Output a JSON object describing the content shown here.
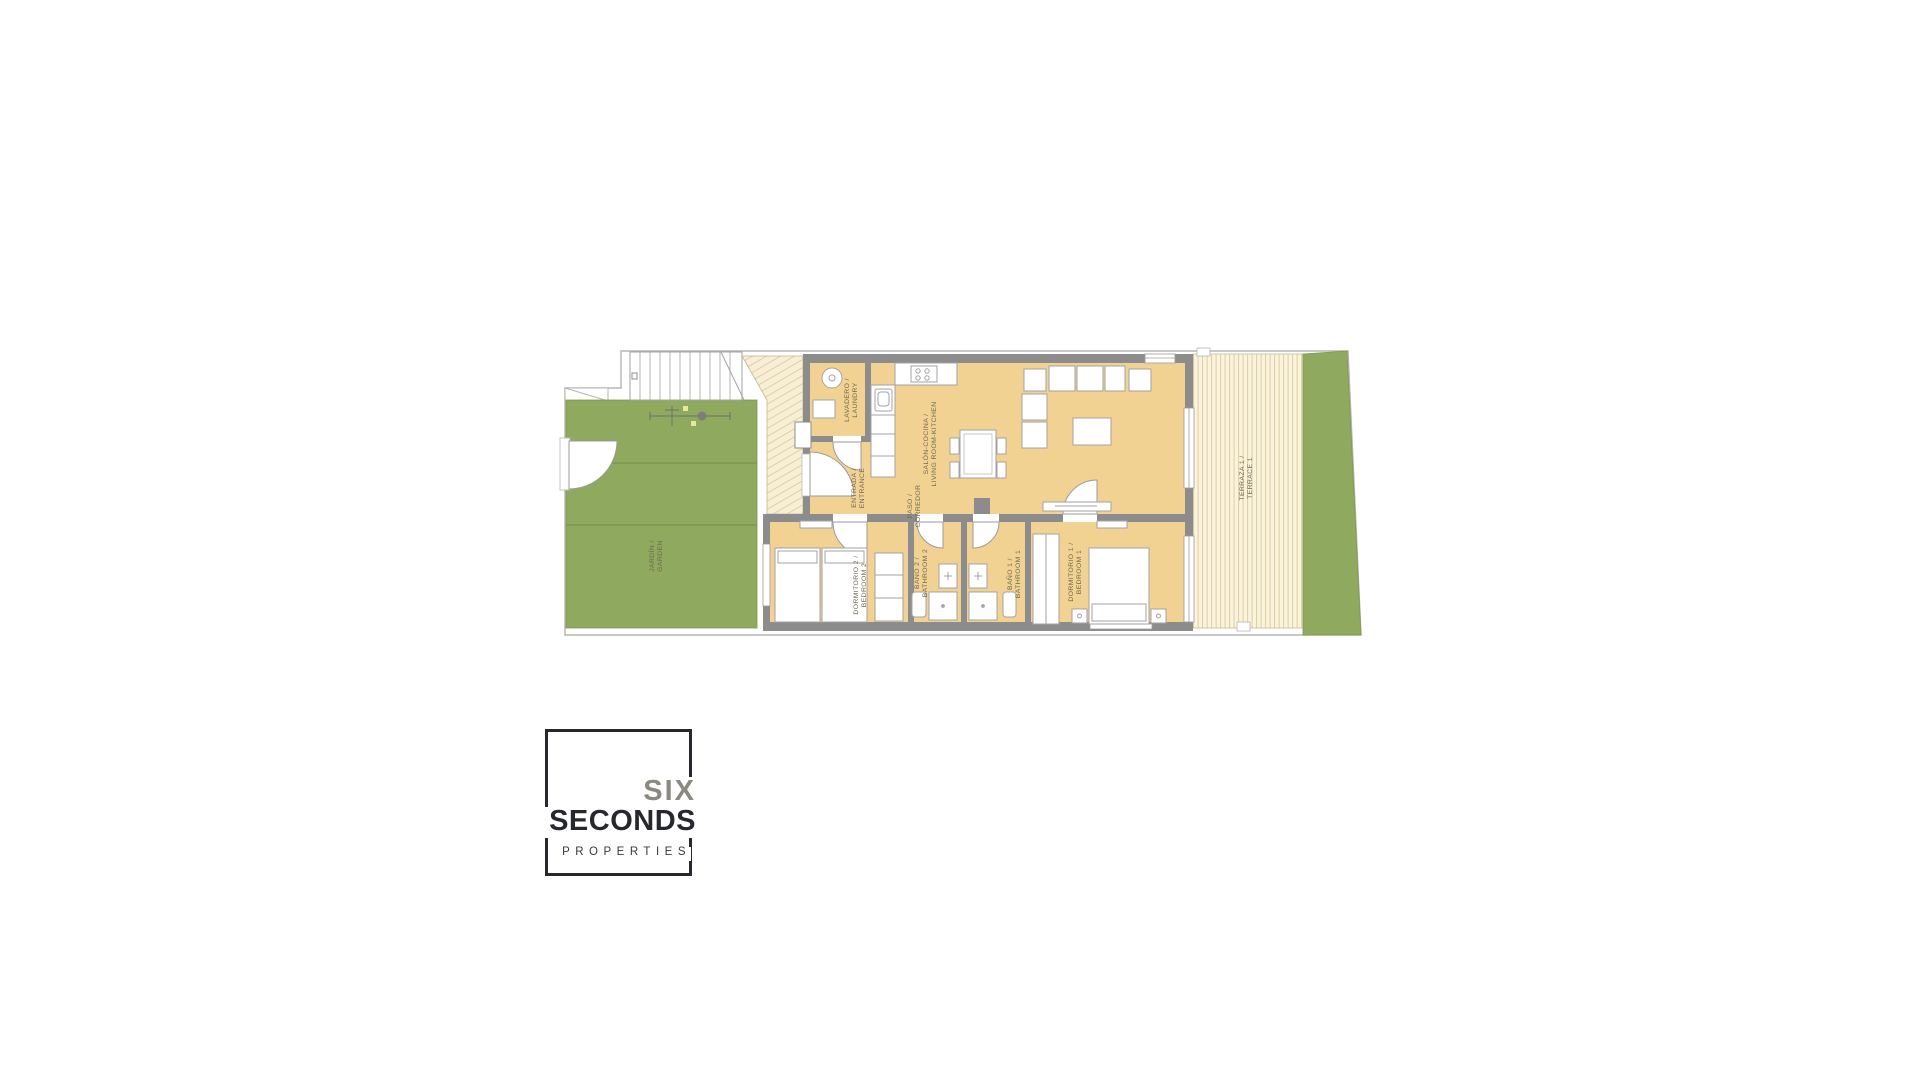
{
  "plan": {
    "labels": {
      "laundry": {
        "es": "LAVADERO /",
        "en": "LAUNDRY"
      },
      "entrance": {
        "es": "ENTRADA /",
        "en": "ENTRANCE"
      },
      "living": {
        "es": "SALÓN-COCINA /",
        "en": "LIVING ROOM-KITCHEN"
      },
      "corridor": {
        "es": "PASO /",
        "en": "CORREDOR"
      },
      "bedroom2": {
        "es": "DORMITORIO 2 /",
        "en": "BEDROOM 2"
      },
      "bath2": {
        "es": "BAÑO 2 /",
        "en": "BATHROOM 2"
      },
      "bath1": {
        "es": "BAÑO 1 /",
        "en": "BATHROOM 1"
      },
      "bedroom1": {
        "es": "DORMITORIO 1 /",
        "en": "BEDROOM 1"
      },
      "garden": {
        "es": "JARDÍN /",
        "en": "GARDEN"
      },
      "terrace": {
        "es": "TERRAZA 1 /",
        "en": "TERRACE 1"
      }
    },
    "colors": {
      "floor": "#f2d292",
      "wall": "#8c8c8c",
      "garden_green": "#8fa95e",
      "terrace_cream": "#faf4de",
      "terrace_stripe": "#dfcc9d",
      "label_text": "#6e6950"
    }
  },
  "logo": {
    "word1": "SIX",
    "word2": "SECONDS",
    "word3": "PROPERTIES"
  }
}
